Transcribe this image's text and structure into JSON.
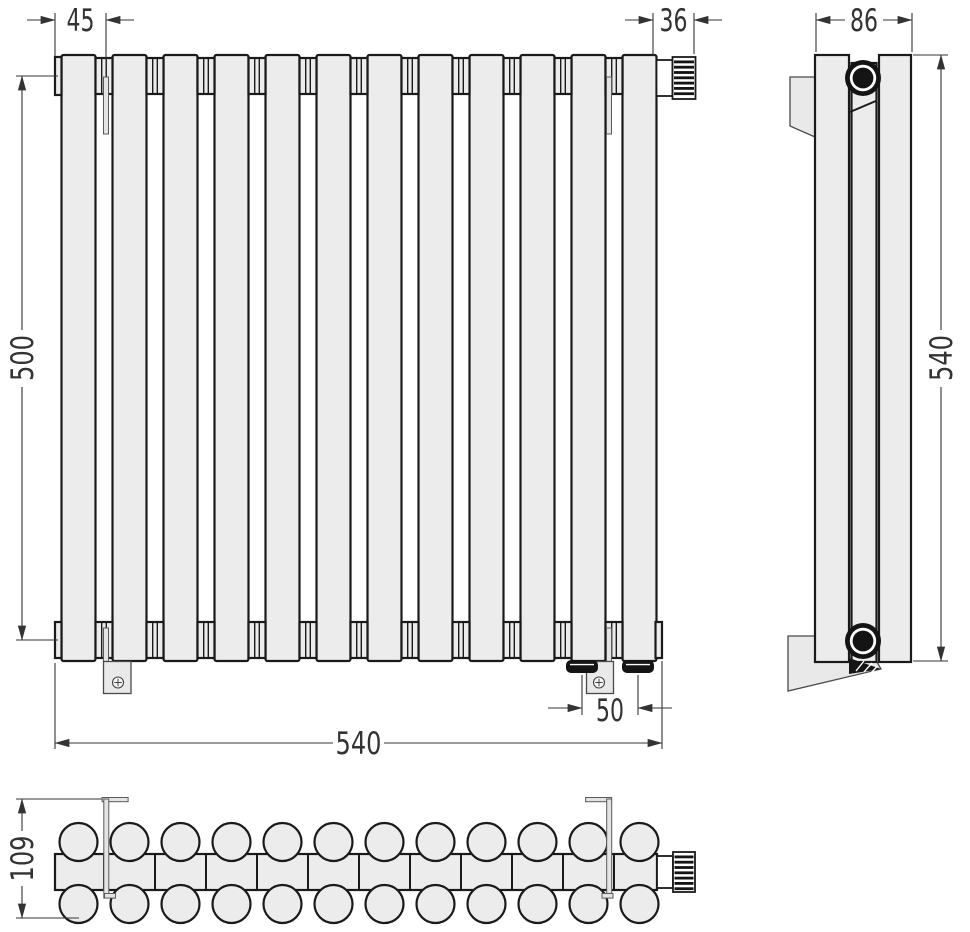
{
  "colors": {
    "line": "#1a1a1a",
    "dim": "#333333",
    "fill": "#ececec",
    "background": "#ffffff"
  },
  "drawing": {
    "subject": "Sectional column radiator - three-view dimensional technical drawing",
    "sections": 12,
    "dims": {
      "bracket_offset_left": "45",
      "valve_connector_width": "36",
      "side_depth": "86",
      "axis_height": "500",
      "total_width": "540",
      "bottom_connection_spacing": "50",
      "side_height": "540",
      "total_depth": "109"
    }
  }
}
